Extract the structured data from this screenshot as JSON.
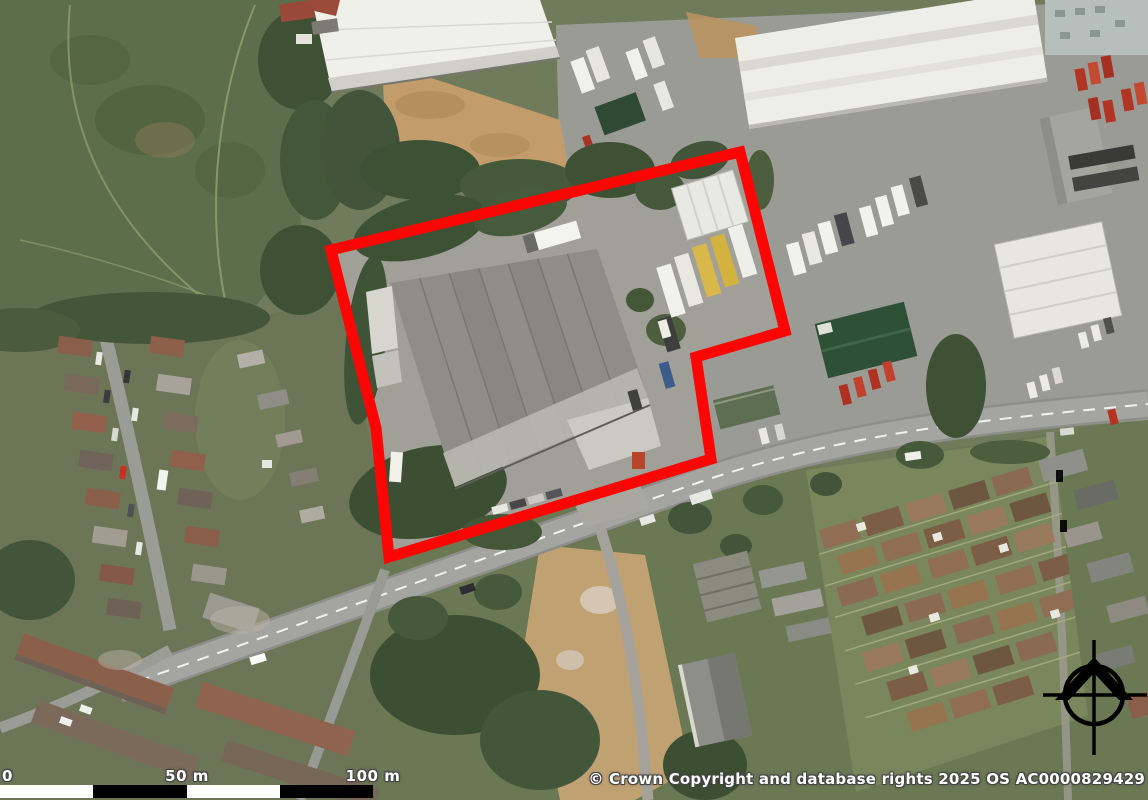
{
  "map": {
    "description": "aerial-photograph-of-industrial-site-with-boundary-overlay",
    "site_boundary": {
      "color": "#fb0505",
      "stroke_width": 11,
      "points": "331,250 740,152 785,331 696,357 711,459 389,557 376,428"
    }
  },
  "scale_bar": {
    "labels": [
      "0",
      "50 m",
      "100 m"
    ],
    "bar_colors": [
      "#ffffff",
      "#000000",
      "#ffffff",
      "#000000"
    ],
    "length_px": 373
  },
  "attribution": {
    "text": "© Crown Copyright and database rights 2025 OS AC0000829429",
    "color": "#ffffff"
  },
  "compass": {
    "icon": "north-compass",
    "color": "#000000"
  }
}
